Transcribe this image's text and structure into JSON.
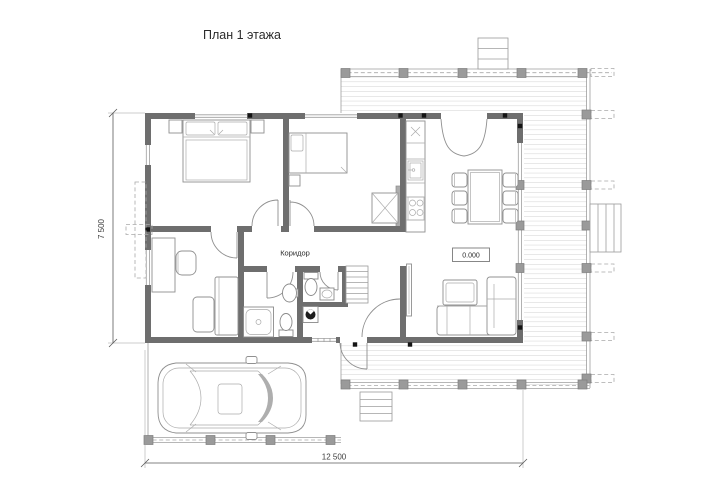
{
  "title": "План 1 этажа",
  "labels": {
    "corridor": "Коридор",
    "elevation": "0.000"
  },
  "dimensions": {
    "height": "7 500",
    "width": "12 500"
  },
  "colors": {
    "bg": "#ffffff",
    "wall": "#6e6e6e",
    "line": "#8f8f8f",
    "deck": "#bfbfbf",
    "dash": "#a9a9a9",
    "post": "#9a9a9a",
    "marker": "#141414",
    "text": "#2b2b2b"
  }
}
